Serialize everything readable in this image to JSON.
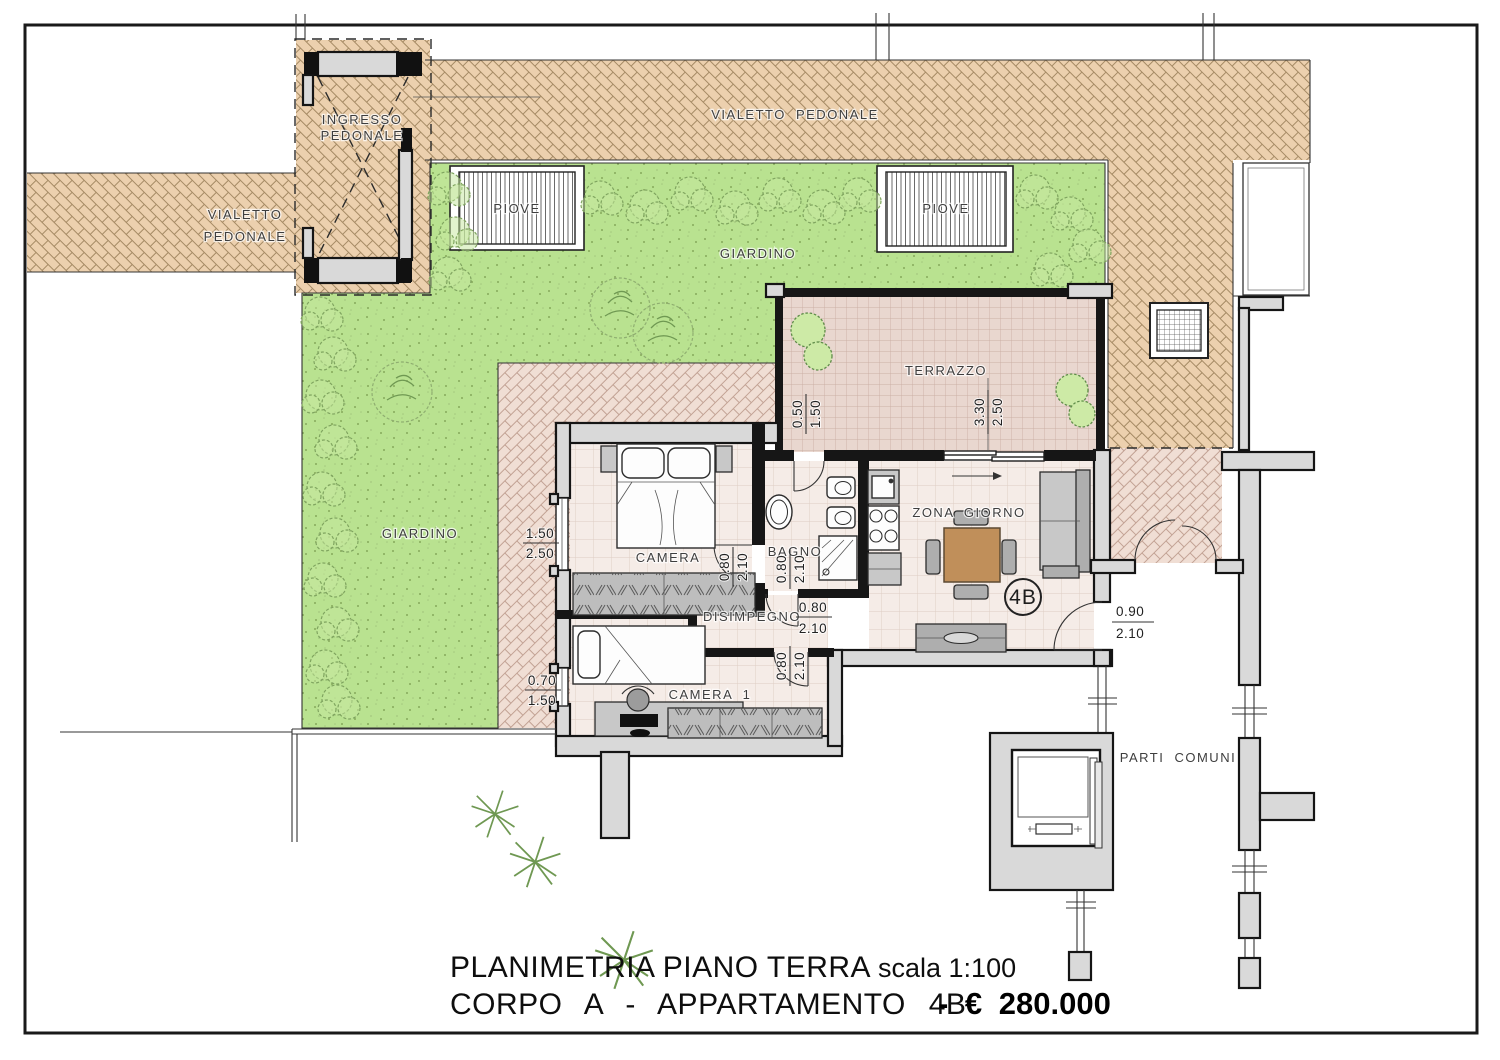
{
  "colors": {
    "paving": "#ecd0ae",
    "paving_line": "#a58a64",
    "paving_pink": "#f0ded4",
    "paving_pink_line": "#c2a294",
    "grass": "#b9e290",
    "grass_dot": "#86a95c",
    "tile": "#e9d7cf",
    "tile_line": "#cbb0a5",
    "floor": "#f5ece7",
    "floor_line": "#ddccc3",
    "wall_fill": "#d9d9d9",
    "table_wood": "#c08f5a"
  },
  "plan": {
    "labels": {
      "ingresso_line1": "INGRESSO",
      "ingresso_line2": "PEDONALE",
      "vialetto_top": "VIALETTO PEDONALE",
      "vialetto_left1": "VIALETTO",
      "vialetto_left2": "PEDONALE",
      "piove": "PIOVE",
      "giardino": "GIARDINO",
      "terrazzo": "TERRAZZO",
      "camera": "CAMERA",
      "bagno": "BAGNO",
      "zona_giorno": "ZONA GIORNO",
      "disimpegno": "DISIMPEGNO",
      "camera1": "CAMERA 1",
      "parti_comuni": "PARTI COMUNI",
      "unit_badge": "4B"
    },
    "dims": {
      "camera_window": {
        "w": "1.50",
        "h": "2.50"
      },
      "camera1_window": {
        "w": "0.70",
        "h": "1.50"
      },
      "interior_door": {
        "w": "0.80",
        "h": "2.10"
      },
      "terrace_door": {
        "w": "0.50",
        "h": "1.50"
      },
      "terrace_window": {
        "w": "3.30",
        "h": "2.50"
      },
      "entrance_door": {
        "w": "0.90",
        "h": "2.10"
      }
    }
  },
  "title_block": {
    "line1": "PLANIMETRIA PIANO TERRA",
    "scale": "scala 1:100",
    "line2": "CORPO A - APPARTAMENTO 4B",
    "price": "- € 280.000"
  }
}
